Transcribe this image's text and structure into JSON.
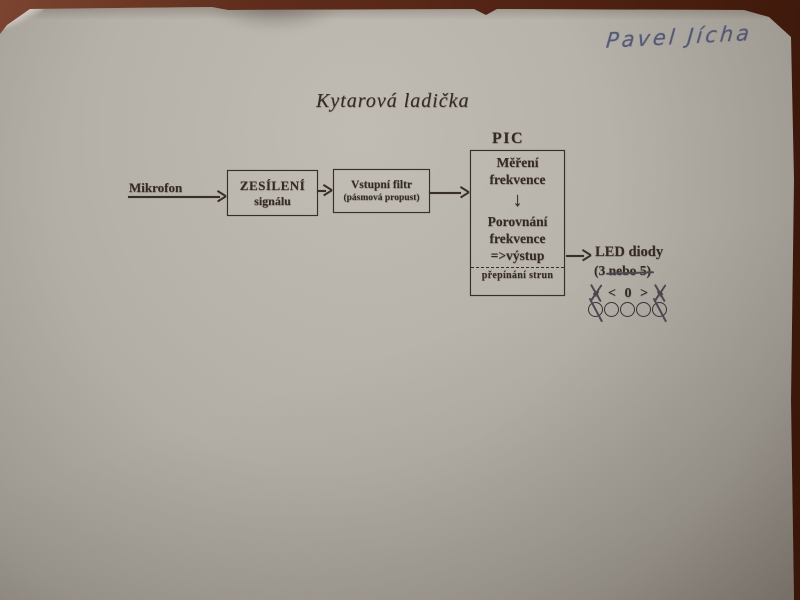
{
  "photo": {
    "background_color": "#5a2718",
    "paper_color": "#b3afa7",
    "print_ink_color": "#362b24",
    "handwriting_ink_color": "#555b7b"
  },
  "handwriting": {
    "author": "Pavel Jícha"
  },
  "title": "Kytarová ladička",
  "diagram": {
    "microphone_label": "Mikrofon",
    "amplifier_box": {
      "line1": "ZESÍLENÍ",
      "line2": "signálu"
    },
    "filter_box": {
      "line1": "Vstupní filtr",
      "line2": "(pásmová propust)"
    },
    "pic_chip_label": "PIC",
    "pic_box": {
      "measure_line1": "Měření",
      "measure_line2": "frekvence",
      "down_arrow": "↓",
      "compare_line1": "Porovnání",
      "compare_line2": "frekvence",
      "compare_line3": "=>výstup",
      "strings_label": "přepínání strun"
    },
    "led": {
      "label": "LED diody",
      "sublabel_prefix": "(3 ",
      "sublabel_struck": "nebo 5)",
      "indicator_symbols": [
        {
          "glyph": "«",
          "crossed": true
        },
        {
          "glyph": "<",
          "crossed": false
        },
        {
          "glyph": "0",
          "crossed": false
        },
        {
          "glyph": ">",
          "crossed": false
        },
        {
          "glyph": "»",
          "crossed": true
        }
      ],
      "indicator_leds": [
        {
          "crossed": true
        },
        {
          "crossed": false
        },
        {
          "crossed": false
        },
        {
          "crossed": false
        },
        {
          "crossed": true
        }
      ]
    }
  }
}
